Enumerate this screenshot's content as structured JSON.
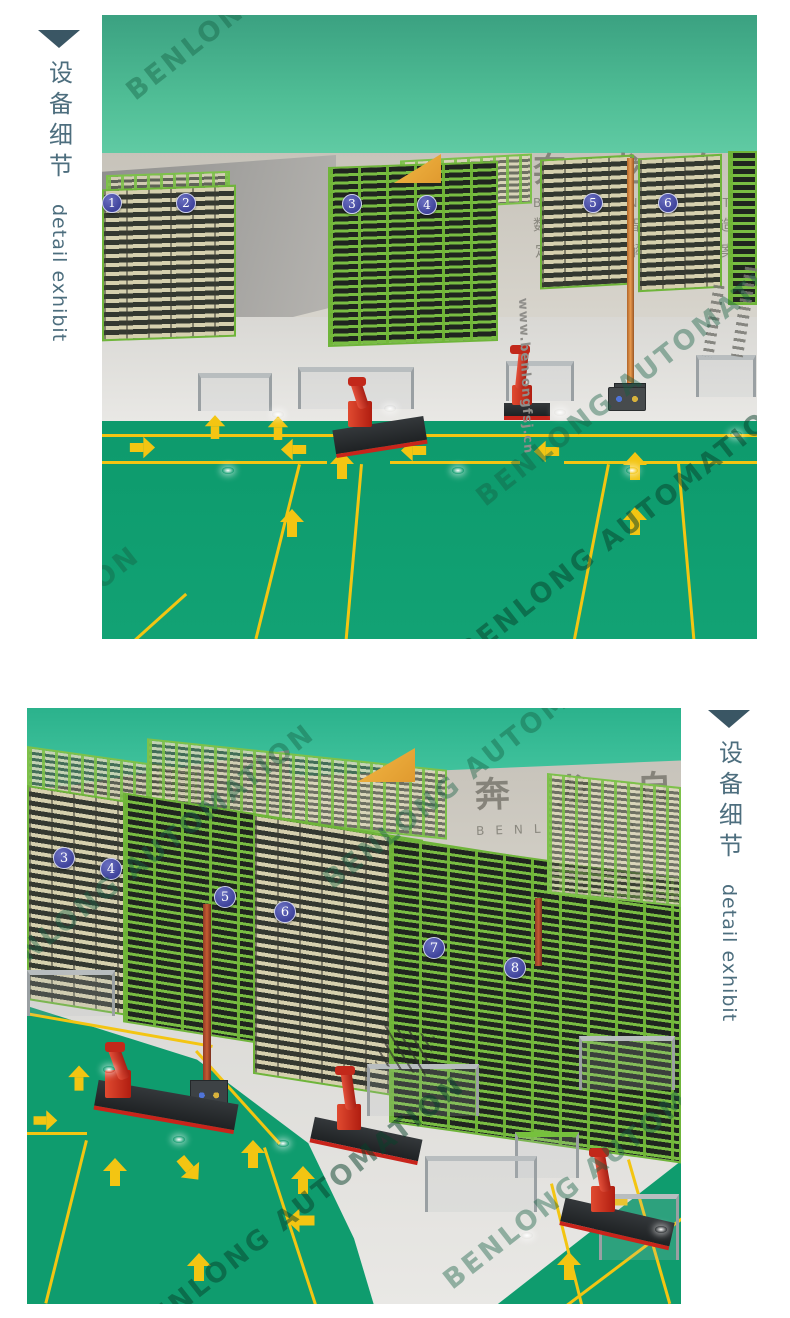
{
  "sidebar": {
    "title_zh": "设备细节",
    "title_en": "detail exhibit"
  },
  "watermark": "BENLONG AUTOMATION",
  "scene_top": {
    "wall_title_zh": "奔龙自动化",
    "wall_title_en": "BENLONG AUTOMATION",
    "wall_slogan_line1": "数字化智能制造",
    "wall_slogan_line2": "定制化解决方案",
    "floor_url": "www.benlongfsj.cn",
    "badges": [
      "1",
      "2",
      "3",
      "4",
      "5",
      "6"
    ]
  },
  "scene_bottom": {
    "wall_title_zh": "奔龙自动化",
    "wall_title_en": "BENLONG AUTOMATION",
    "badges": [
      "3",
      "4",
      "5",
      "6",
      "7",
      "8"
    ]
  },
  "colors": {
    "teal_background": "#3fae87",
    "floor_green": "#0f9c6e",
    "lane_yellow": "#f3c512",
    "badge_indigo": "#4347a0",
    "robot_red": "#c8241b",
    "rack_green": "#76c13d",
    "sidebar_text": "#4d6e7e",
    "sidebar_triangle": "#3a5664"
  }
}
